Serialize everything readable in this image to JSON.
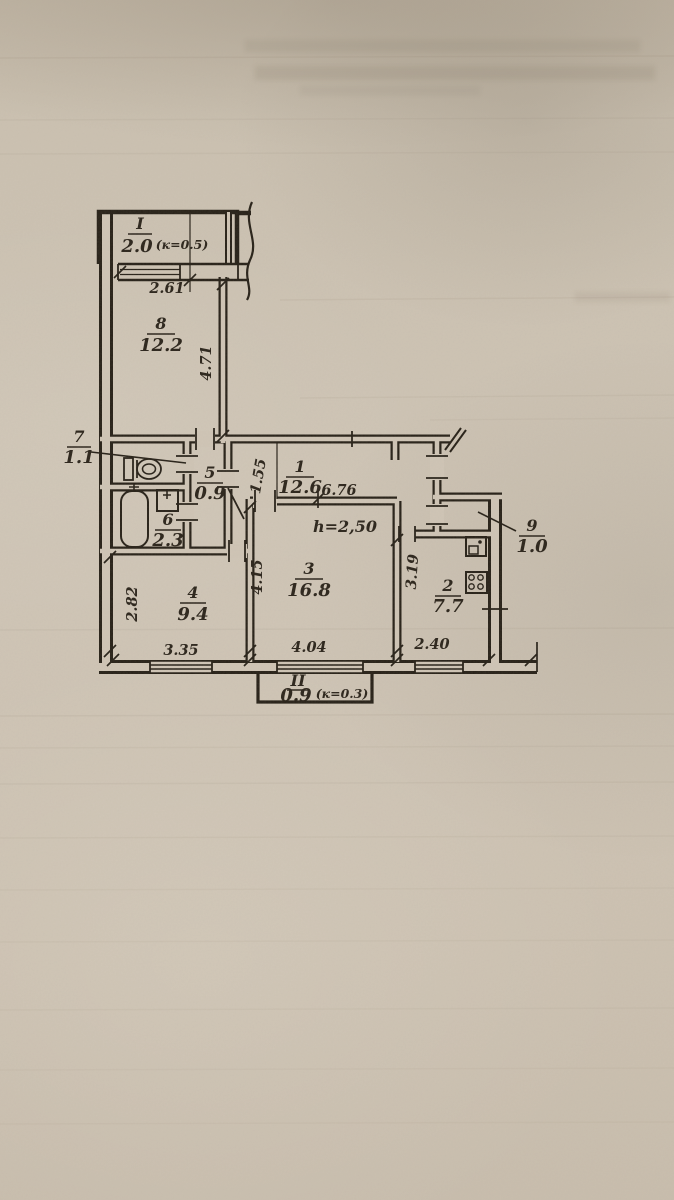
{
  "plan": {
    "rooms": {
      "r1": {
        "number": "1",
        "area": "12.6"
      },
      "r2": {
        "number": "2",
        "area": "7.7"
      },
      "r3": {
        "number": "3",
        "area": "16.8"
      },
      "r4": {
        "number": "4",
        "area": "9.4"
      },
      "r5": {
        "number": "5",
        "area": "0.9"
      },
      "r6": {
        "number": "6",
        "area": "2.3"
      },
      "r7": {
        "number": "7",
        "area": "1.1"
      },
      "r8": {
        "number": "8",
        "area": "12.2"
      },
      "r9": {
        "number": "9",
        "area": "1.0"
      }
    },
    "balcony_top": {
      "number": "I",
      "area": "2.0",
      "coef": "(к=0.5)"
    },
    "balcony_bottom": {
      "number": "II",
      "area": "0.9",
      "coef": "(к=0.3)"
    },
    "annotations": {
      "ceiling_height": "h=2,50"
    },
    "dims": {
      "top_window": "2.61",
      "room8_depth": "4.71",
      "corridor_width": "1.55",
      "corridor_length": "6.76",
      "room4_width": "2.82",
      "room4_length": "3.35",
      "room3_depth": "4.15",
      "room3_width": "4.04",
      "kitchen_depth": "3.19",
      "kitchen_width": "2.40"
    },
    "ink_color": "#2a231a",
    "paper_color": "#cfc5b6"
  }
}
